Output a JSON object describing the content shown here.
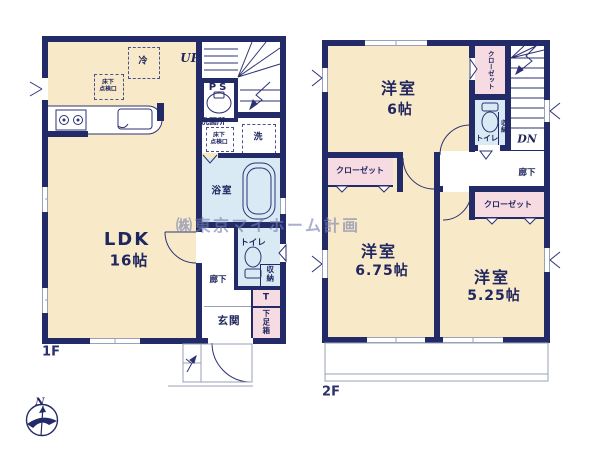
{
  "watermark": "㈱東京マイホーム計画",
  "compass": {
    "north": "N"
  },
  "floor1": {
    "label": "1F",
    "stairs": "UP",
    "ldk": {
      "name": "LDK",
      "size": "16帖"
    },
    "bath": "浴室",
    "washroom": "洗面所",
    "toilet": "トイレ",
    "storage": "収納",
    "hallway": "廊下",
    "entrance": "玄関",
    "shoe_cabinet": "下足箱",
    "towel": "T",
    "pipe_space": "PS",
    "fridge": "冷",
    "washer": "洗",
    "floor_hatch": {
      "line1": "床下",
      "line2": "点検口"
    }
  },
  "floor2": {
    "label": "2F",
    "stairs": "DN",
    "bedroom_a": {
      "name": "洋室",
      "size": "6帖"
    },
    "bedroom_b": {
      "name": "洋室",
      "size": "6.75帖"
    },
    "bedroom_c": {
      "name": "洋室",
      "size": "5.25帖"
    },
    "closet_a": "クローゼット",
    "closet_b": "クローゼット",
    "closet_c": "クローゼット",
    "toilet": "トイレ",
    "storage": "収納",
    "hallway": "廊下"
  }
}
